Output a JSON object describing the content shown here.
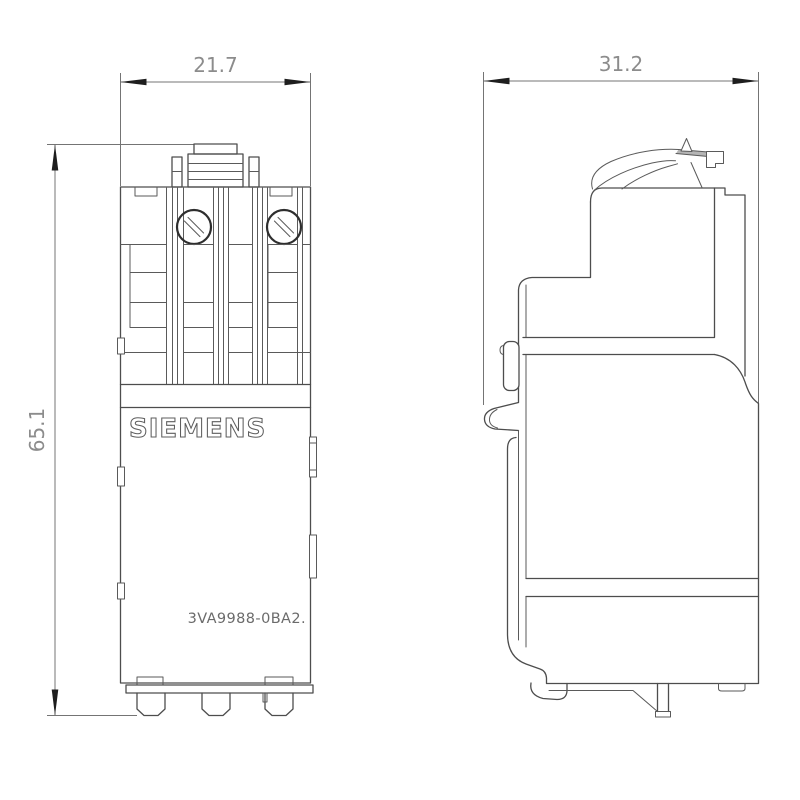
{
  "page": {
    "background": "#ffffff"
  },
  "drawing": {
    "brand": "SIEMENS",
    "part_number": "3VA9988-0BA2.",
    "views": [
      {
        "id": "front-view",
        "name": "front view"
      },
      {
        "id": "side-view",
        "name": "side view"
      }
    ],
    "dimensions": [
      {
        "id": "front-width",
        "value": "21.7",
        "orientation": "horizontal"
      },
      {
        "id": "side-depth",
        "value": "31.2",
        "orientation": "horizontal"
      },
      {
        "id": "height",
        "value": "65.1",
        "orientation": "vertical"
      }
    ],
    "colors": {
      "object_line": "#4d4d4d",
      "dimension_line": "#747474",
      "arrowhead": "#1e1e1e",
      "dimension_text": "#8c8c8c",
      "logo_outline": "#5e5e5e",
      "part_number_text": "#6b6b6b",
      "lever_shade": "#b5b5b5"
    }
  }
}
